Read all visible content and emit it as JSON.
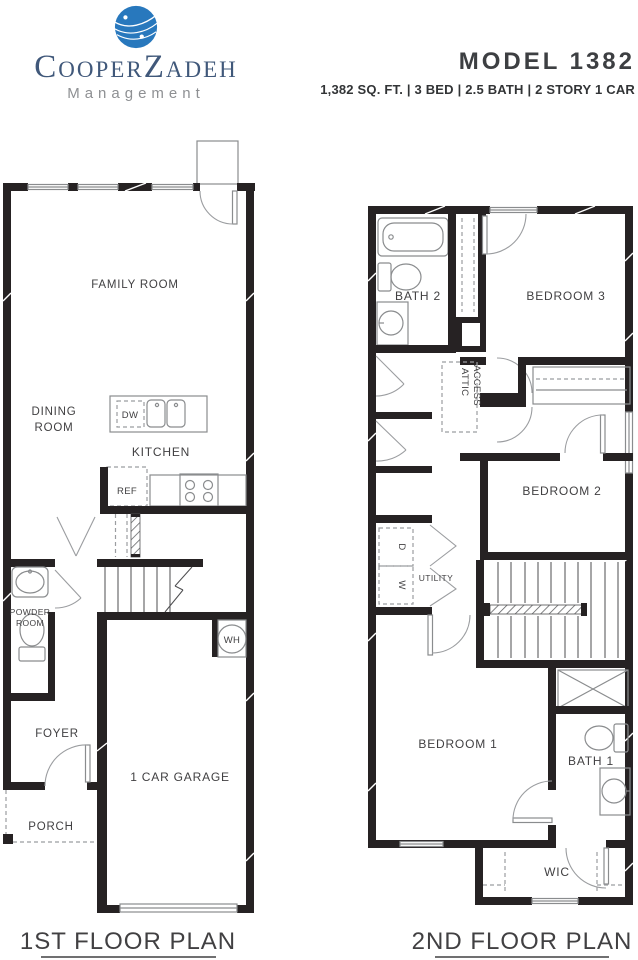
{
  "header": {
    "logo": {
      "name_part1": "Cooper",
      "name_part2": "Zadeh",
      "subtitle": "Management",
      "globe_color": "#2878bd"
    },
    "model_title": "MODEL 1382",
    "specs": "1,382 SQ. FT. | 3 BED | 2.5 BATH | 2 STORY 1 CAR"
  },
  "floor1": {
    "title": "1ST FLOOR PLAN",
    "labels": {
      "family_room": "FAMILY ROOM",
      "dining_line1": "DINING",
      "dining_line2": "ROOM",
      "kitchen": "KITCHEN",
      "dw": "DW",
      "ref": "REF",
      "powder_line1": "POWDER",
      "powder_line2": "ROOM",
      "foyer": "FOYER",
      "garage": "1 CAR GARAGE",
      "porch": "PORCH",
      "wh": "WH"
    }
  },
  "floor2": {
    "title": "2ND FLOOR PLAN",
    "labels": {
      "bath2": "BATH 2",
      "bedroom3": "BEDROOM 3",
      "attic_line1": "ATTIC",
      "attic_line2": "ACCESS",
      "bedroom2": "BEDROOM 2",
      "d": "D",
      "w": "W",
      "utility": "UTILITY",
      "bedroom1": "BEDROOM 1",
      "bath1": "BATH 1",
      "wic": "WIC"
    }
  },
  "colors": {
    "wall": "#262223",
    "fixture_gray": "#8a8c8e",
    "text": "#414042",
    "logo_blue": "#2878bd",
    "logo_text": "#40587a",
    "management_gray": "#8e9093"
  }
}
